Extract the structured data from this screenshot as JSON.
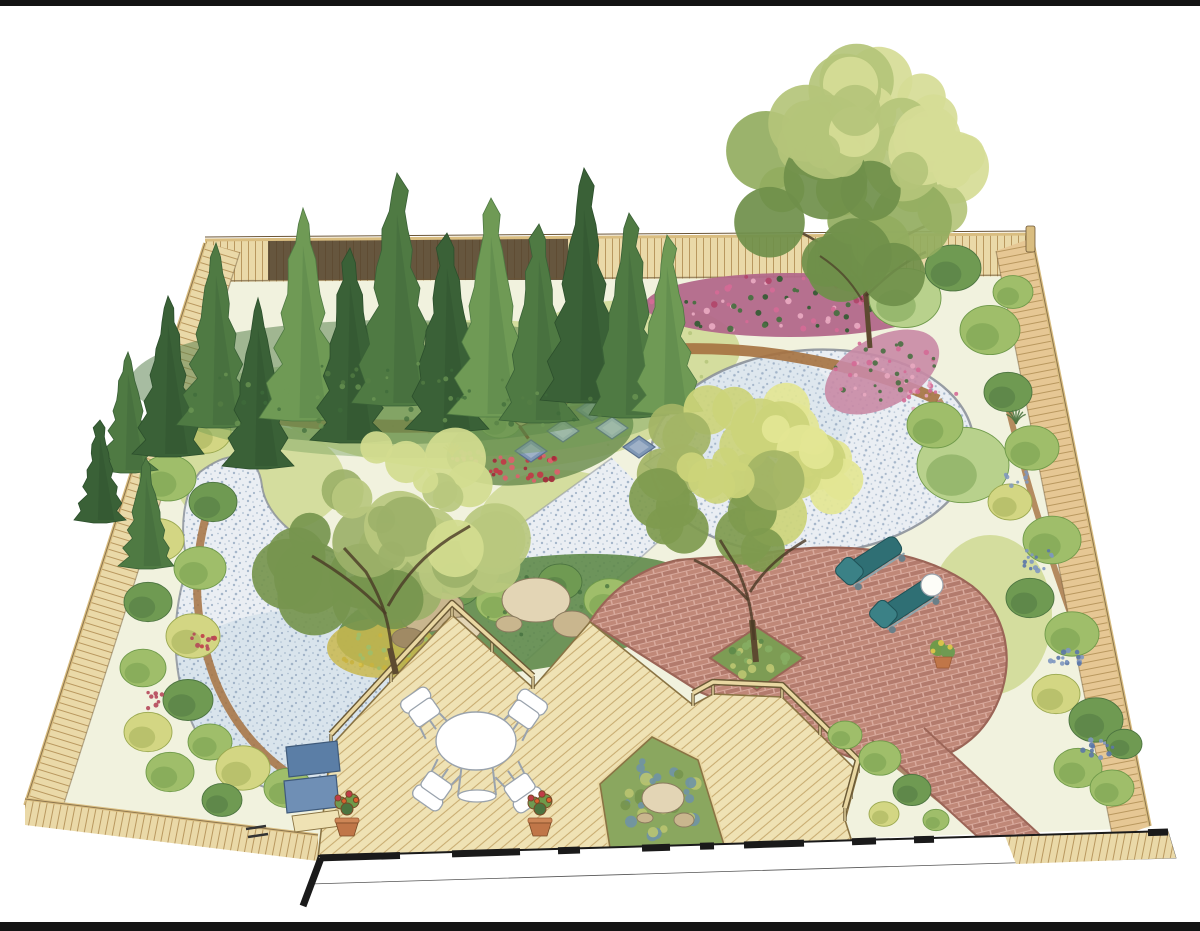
{
  "figure": {
    "kind": "Hand-drawn backyard landscape design plan, aerial perspective",
    "alt": "Watercolor-style aerial illustration of a fenced backyard: an evergreen conifer screen and large shade trees along the back, a pink flowering border, organic gravel areas crossed by square stepping stones beside a rustic wooden bench, boulder accents, a diagonal-plank wood deck with a white dining set, terracotta planters and a rock pond cutout, and a circular brick patio with two teal lounge chairs joined by a brick walkway, all enclosed by tan picket fencing with the house wall along the bottom edge."
  },
  "palette": {
    "paper": "#ffffff",
    "frame_bar": "#141414",
    "ground": "#f1f2de",
    "meadow": "#cfd993",
    "meadow_stroke": "#a9bd6c",
    "gravel_base": "#eaeef3",
    "gravel_dot": "#93a8bf",
    "gravel_edge": "#878d97",
    "gravel_wash": "#c5d6e4",
    "fence_wood": "#ead9a8",
    "fence_wood_right": "#e6c794",
    "fence_line": "#b9985f",
    "fence_cap": "#d9bd80",
    "fence_dark": "#4f3e2c",
    "deck_wood": "#efe2b4",
    "deck_line": "#c9ad72",
    "deck_edge": "#8a7444",
    "rail_dark": "#6b5a36",
    "rail_light": "#e9d7a2",
    "brick_base": "#d8a99c",
    "brick_unit": "#c08878",
    "brick_unit2": "#b37b6d",
    "brick_edge": "#9b6557",
    "conifer_dark": "#3a6137",
    "conifer_shade": "#2c4f2c",
    "conifer_mid": "#4f7a43",
    "conifer_light": "#6f9a55",
    "conifer_pale": "#86ad62",
    "canopy_dark": "#76954e",
    "canopy_olive": "#9cb169",
    "canopy_light": "#b8c87e",
    "canopy_pale": "#d3dc8f",
    "canopy_yellow": "#e3e694",
    "trunk": "#5d4a30",
    "branch": "#4a3a26",
    "shrub_yellow": "#d3d683",
    "shrub_yellow_dark": "#9aa84f",
    "shrub_green": "#9fbe6a",
    "shrub_green_dark": "#6f9a4a",
    "shrub_deep": "#6f9a52",
    "shrub_deep_dark": "#4c7440",
    "shrub_pale": "#b8d18c",
    "flower_pink": "#d46a96",
    "flower_rose": "#b2476b",
    "flower_pink_pale": "#e8a8c0",
    "flower_red": "#c03c48",
    "flower_blue": "#7e97c0",
    "flower_blue_dark": "#5b77a8",
    "flower_yellow": "#d9c34a",
    "mulch": "#a5713f",
    "soil": "#8a5a36",
    "stone_slate": "#7f97b5",
    "stone_light": "#aabdd3",
    "stone_edge": "#5a708c",
    "slab_blue": "#5b7ea6",
    "slab_blue2": "#6f8fb5",
    "rock_light": "#e3d5b5",
    "rock_mid": "#c9b68e",
    "rock_dark": "#a08a64",
    "bench_wood": "#dfc183",
    "bench_line": "#6b4f28",
    "white_furniture": "#ffffff",
    "furniture_line": "#9aa3ad",
    "lounge_teal": "#2f6f74",
    "lounge_teal2": "#3b8186",
    "lounge_frame": "#8fa6ad",
    "pot_clay": "#c07648",
    "pot_dark": "#9c5a33",
    "pond_green": "#8aa75f",
    "pond_blue": "#6f93a5",
    "pond_moss": "#b9c470",
    "wall_black": "#1a1a1a"
  }
}
